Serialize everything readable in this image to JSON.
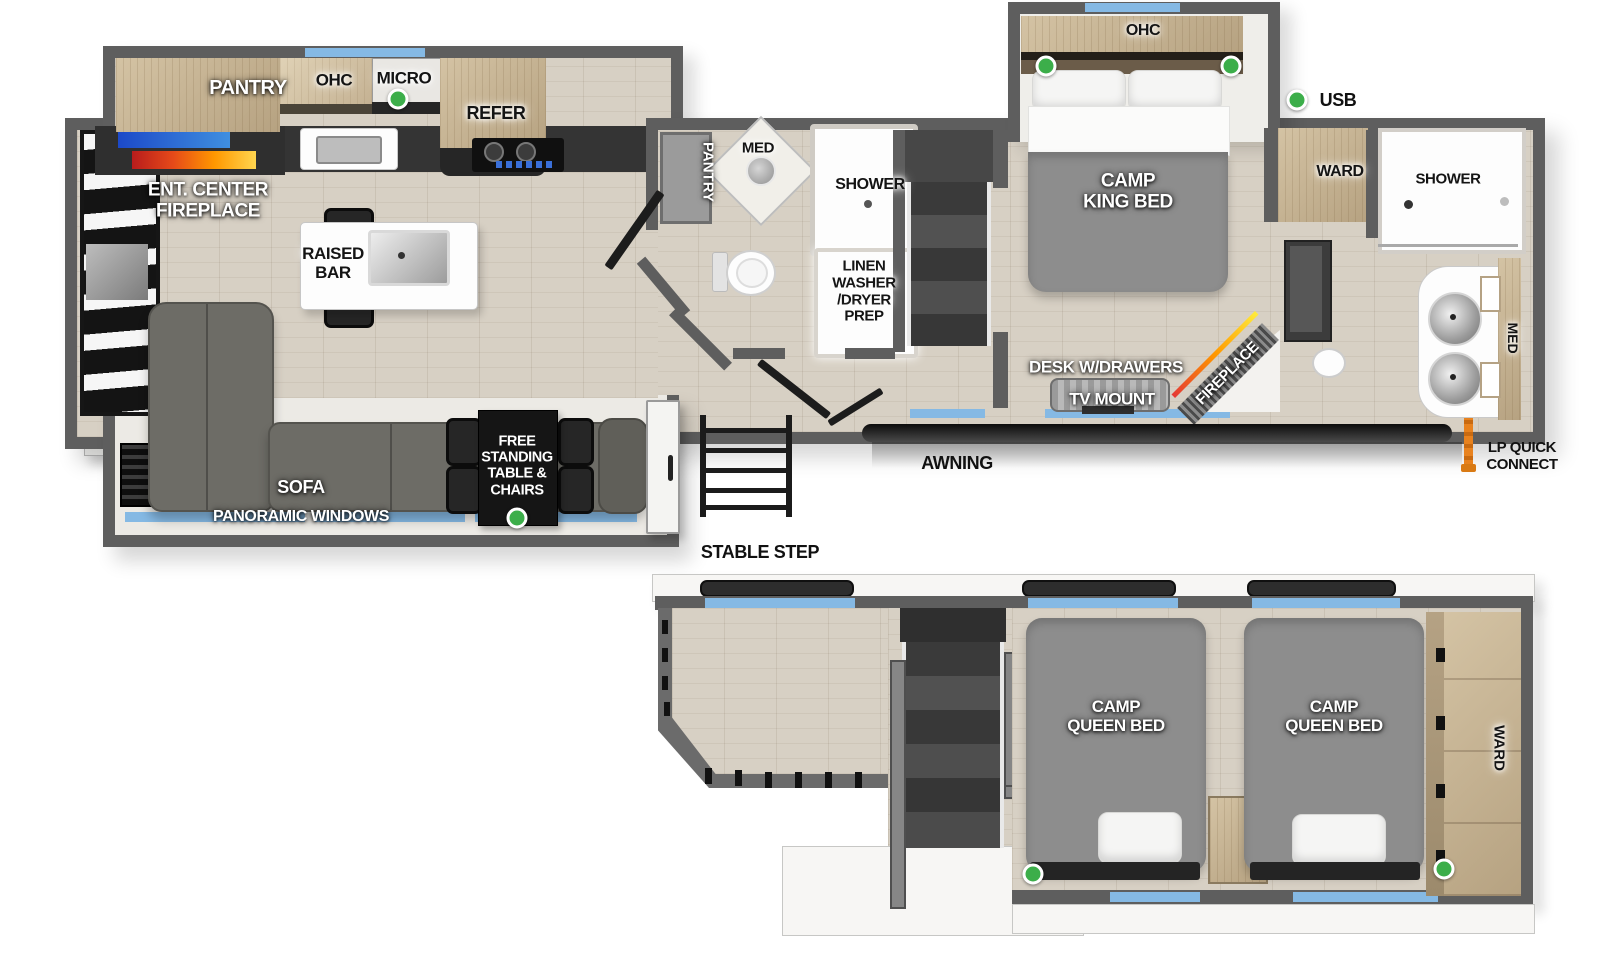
{
  "main_floor": {
    "kitchen": {
      "pantry": "PANTRY",
      "ohc": "OHC",
      "micro": "MICRO",
      "refer": "REFER",
      "ent_center_fireplace": "ENT. CENTER\nFIREPLACE",
      "raised_bar": "RAISED\nBAR"
    },
    "bath": {
      "pantry": "PANTRY",
      "med": "MED",
      "shower": "SHOWER",
      "linen_prep": "LINEN\nWASHER\n/DRYER\nPREP"
    },
    "bedroom": {
      "ohc": "OHC",
      "king_bed": "CAMP\nKING BED",
      "ward": "WARD",
      "desk": "DESK W/DRAWERS",
      "tv_mount": "TV MOUNT",
      "fireplace": "FIREPLACE"
    },
    "rear_bath": {
      "shower": "SHOWER",
      "med": "MED"
    },
    "living": {
      "sofa": "SOFA",
      "panoramic_windows": "PANORAMIC WINDOWS",
      "free_standing_table": "FREE\nSTANDING\nTABLE &\nCHAIRS"
    }
  },
  "callouts": {
    "usb": "USB",
    "awning": "AWNING",
    "stable_step": "STABLE STEP",
    "lp_quick_connect": "LP QUICK\nCONNECT"
  },
  "lower_floor": {
    "queen_bed_1": "CAMP\nQUEEN BED",
    "queen_bed_2": "CAMP\nQUEEN BED",
    "ward": "WARD"
  },
  "colors": {
    "wall_gray": "#5e5e5e",
    "floor_wood": "#d7d0c4",
    "cabinet_wood": "#c9b593",
    "bed_gray": "#8d8d8d",
    "window_blue": "#85b9e4",
    "usb_green": "#3cae4a",
    "awning_black": "#1a1a1a",
    "lp_orange": "#e8821e"
  }
}
